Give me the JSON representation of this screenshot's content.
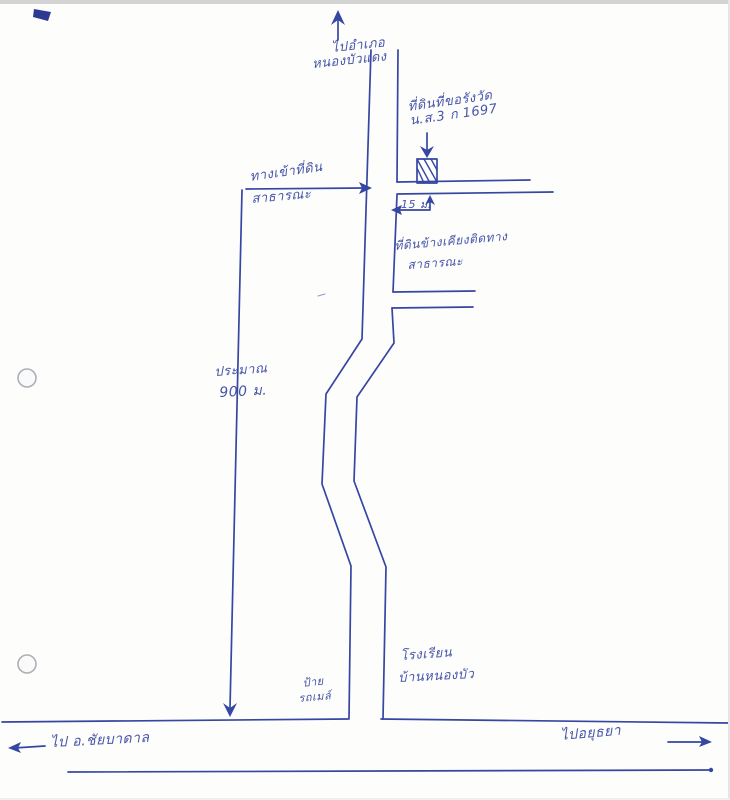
{
  "ink_color": "#3646a3",
  "paper_color": "#fdfdfb",
  "map": {
    "top_destination": {
      "line1": "ไปอำเภอ",
      "line2": "หนองบัวแดง"
    },
    "subject_parcel": {
      "line1": "ที่ดินที่ขอรังวัด",
      "line2": "น.ส.3 ก 1697"
    },
    "entrance_road": {
      "line1": "ทางเข้าที่ดิน",
      "line2": "สาธารณะ"
    },
    "adjacent_parcel": {
      "line1": "ที่ดินข้างเคียงติดทาง",
      "line2": "สาธารณะ"
    },
    "width_dimension": "15 ม.",
    "distance_dimension": {
      "line1": "ประมาณ",
      "line2": "900 ม."
    },
    "bus_stop": {
      "line1": "ป้าย",
      "line2": "รถเมล์"
    },
    "school": {
      "line1": "โรงเรียน",
      "line2": "บ้านหนองบัว"
    },
    "west_destination": "ไป อ.ชัยบาดาล",
    "east_destination": "ไปอยุธยา"
  }
}
